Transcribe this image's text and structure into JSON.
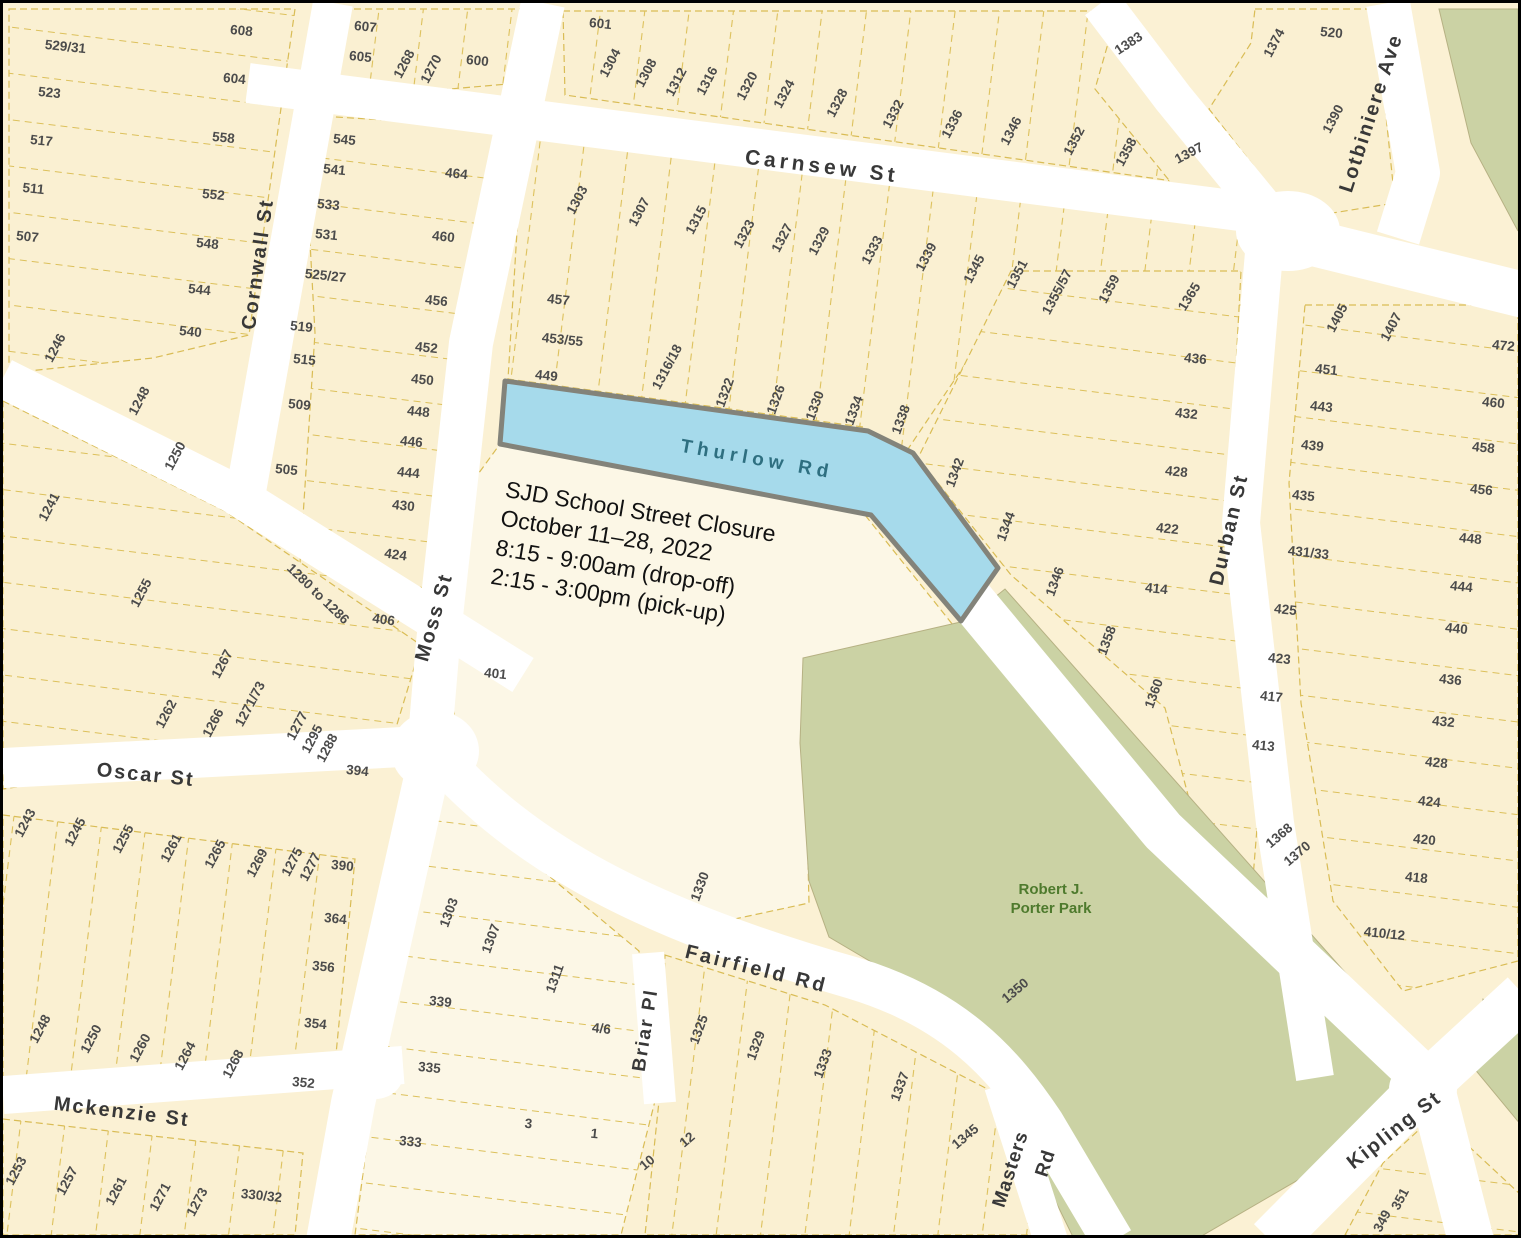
{
  "title": "SJD School Street Closure map",
  "colors": {
    "parcel_fill": "#FAF0D2",
    "parcel_fill_light": "#FCF7E6",
    "parcel_line": "#D9BC55",
    "street_fill": "#FFFFFF",
    "park_fill": "#CBD2A4",
    "closure_fill": "#A6DAEB",
    "closure_border": "#83837A",
    "street_label": "#383838",
    "lot_label": "#4B4B4B",
    "thurlow_label": "#2E6F80",
    "park_label": "#4E7A2D"
  },
  "annotation": {
    "lines": [
      "SJD School Street Closure",
      "October 11–28, 2022",
      "8:15 - 9:00am (drop-off)",
      "2:15 - 3:00pm (pick-up)"
    ]
  },
  "park": {
    "line1": "Robert J.",
    "line2": "Porter Park"
  },
  "street_labels": [
    {
      "text": "Carnsew St",
      "x": 818,
      "y": 170,
      "rot": 7,
      "size": 21,
      "ls": 4
    },
    {
      "text": "Cornwall St",
      "x": 261,
      "y": 262,
      "rot": -82,
      "size": 20,
      "ls": 2
    },
    {
      "text": "Moss St",
      "x": 437,
      "y": 616,
      "rot": -74,
      "size": 20,
      "ls": 2
    },
    {
      "text": "Thurlow Rd",
      "x": 753,
      "y": 462,
      "rot": 10,
      "size": 19,
      "ls": 5,
      "color": "#2E6F80"
    },
    {
      "text": "Oscar St",
      "x": 142,
      "y": 778,
      "rot": 6,
      "size": 20,
      "ls": 2
    },
    {
      "text": "Mckenzie St",
      "x": 118,
      "y": 1115,
      "rot": 7,
      "size": 20,
      "ls": 2
    },
    {
      "text": "Fairfield Rd",
      "x": 752,
      "y": 972,
      "rot": 14,
      "size": 20,
      "ls": 3
    },
    {
      "text": "Briar Pl",
      "x": 648,
      "y": 1028,
      "rot": -81,
      "size": 19,
      "ls": 2
    },
    {
      "text": "Masters",
      "x": 1013,
      "y": 1168,
      "rot": -72,
      "size": 19,
      "ls": 1
    },
    {
      "text": "Rd",
      "x": 1048,
      "y": 1162,
      "rot": -72,
      "size": 19,
      "ls": 1
    },
    {
      "text": "Durban St",
      "x": 1232,
      "y": 528,
      "rot": -77,
      "size": 20,
      "ls": 2
    },
    {
      "text": "Lotbiniere Ave",
      "x": 1374,
      "y": 112,
      "rot": -72,
      "size": 20,
      "ls": 2
    },
    {
      "text": "Kipling St",
      "x": 1395,
      "y": 1132,
      "rot": -38,
      "size": 20,
      "ls": 2
    }
  ],
  "lots": [
    {
      "t": "529/31",
      "x": 62,
      "y": 48,
      "r": 6
    },
    {
      "t": "523",
      "x": 46,
      "y": 94,
      "r": 6
    },
    {
      "t": "517",
      "x": 38,
      "y": 142,
      "r": 6
    },
    {
      "t": "511",
      "x": 30,
      "y": 190,
      "r": 6
    },
    {
      "t": "507",
      "x": 24,
      "y": 238,
      "r": 6
    },
    {
      "t": "608",
      "x": 238,
      "y": 32,
      "r": 6
    },
    {
      "t": "604",
      "x": 231,
      "y": 80,
      "r": 6
    },
    {
      "t": "558",
      "x": 220,
      "y": 139,
      "r": 6
    },
    {
      "t": "552",
      "x": 210,
      "y": 196,
      "r": 6
    },
    {
      "t": "548",
      "x": 204,
      "y": 245,
      "r": 6
    },
    {
      "t": "544",
      "x": 196,
      "y": 291,
      "r": 6
    },
    {
      "t": "540",
      "x": 187,
      "y": 333,
      "r": 6
    },
    {
      "t": "1246",
      "x": 56,
      "y": 347,
      "r": -62
    },
    {
      "t": "1248",
      "x": 140,
      "y": 400,
      "r": -62
    },
    {
      "t": "1250",
      "x": 176,
      "y": 455,
      "r": -62
    },
    {
      "t": "1241",
      "x": 50,
      "y": 506,
      "r": -62
    },
    {
      "t": "1255",
      "x": 142,
      "y": 592,
      "r": -62
    },
    {
      "t": "607",
      "x": 362,
      "y": 28,
      "r": 6
    },
    {
      "t": "605",
      "x": 357,
      "y": 58,
      "r": 6
    },
    {
      "t": "1268",
      "x": 405,
      "y": 63,
      "r": -62
    },
    {
      "t": "1270",
      "x": 432,
      "y": 68,
      "r": -62
    },
    {
      "t": "600",
      "x": 474,
      "y": 62,
      "r": 6
    },
    {
      "t": "545",
      "x": 341,
      "y": 141,
      "r": 6
    },
    {
      "t": "541",
      "x": 331,
      "y": 171,
      "r": 6
    },
    {
      "t": "533",
      "x": 325,
      "y": 206,
      "r": 6
    },
    {
      "t": "531",
      "x": 323,
      "y": 236,
      "r": 6
    },
    {
      "t": "525/27",
      "x": 322,
      "y": 277,
      "r": 6
    },
    {
      "t": "519",
      "x": 298,
      "y": 328,
      "r": 6
    },
    {
      "t": "515",
      "x": 301,
      "y": 361,
      "r": 6
    },
    {
      "t": "509",
      "x": 296,
      "y": 406,
      "r": 6
    },
    {
      "t": "505",
      "x": 283,
      "y": 471,
      "r": 6
    },
    {
      "t": "464",
      "x": 453,
      "y": 175,
      "r": 6
    },
    {
      "t": "460",
      "x": 440,
      "y": 238,
      "r": 6
    },
    {
      "t": "456",
      "x": 433,
      "y": 302,
      "r": 6
    },
    {
      "t": "452",
      "x": 423,
      "y": 349,
      "r": 6
    },
    {
      "t": "450",
      "x": 419,
      "y": 381,
      "r": 6
    },
    {
      "t": "448",
      "x": 415,
      "y": 413,
      "r": 6
    },
    {
      "t": "446",
      "x": 408,
      "y": 443,
      "r": 6
    },
    {
      "t": "444",
      "x": 405,
      "y": 474,
      "r": 6
    },
    {
      "t": "430",
      "x": 400,
      "y": 507,
      "r": 6
    },
    {
      "t": "424",
      "x": 392,
      "y": 556,
      "r": 8
    },
    {
      "t": "406",
      "x": 380,
      "y": 621,
      "r": 8
    },
    {
      "t": "1280 to 1286",
      "x": 312,
      "y": 594,
      "r": 44
    },
    {
      "t": "601",
      "x": 597,
      "y": 25,
      "r": 6
    },
    {
      "t": "1304",
      "x": 611,
      "y": 62,
      "r": -62
    },
    {
      "t": "1308",
      "x": 647,
      "y": 72,
      "r": -62
    },
    {
      "t": "1312",
      "x": 677,
      "y": 81,
      "r": -62
    },
    {
      "t": "1316",
      "x": 708,
      "y": 80,
      "r": -62
    },
    {
      "t": "1320",
      "x": 748,
      "y": 85,
      "r": -62
    },
    {
      "t": "1324",
      "x": 785,
      "y": 93,
      "r": -62
    },
    {
      "t": "1328",
      "x": 838,
      "y": 102,
      "r": -62
    },
    {
      "t": "1332",
      "x": 894,
      "y": 113,
      "r": -62
    },
    {
      "t": "1336",
      "x": 953,
      "y": 123,
      "r": -62
    },
    {
      "t": "1346",
      "x": 1012,
      "y": 130,
      "r": -62
    },
    {
      "t": "1352",
      "x": 1075,
      "y": 140,
      "r": -62
    },
    {
      "t": "1358",
      "x": 1127,
      "y": 151,
      "r": -62
    },
    {
      "t": "1383",
      "x": 1128,
      "y": 44,
      "r": -33
    },
    {
      "t": "1397",
      "x": 1188,
      "y": 154,
      "r": -28
    },
    {
      "t": "1374",
      "x": 1275,
      "y": 42,
      "r": -62
    },
    {
      "t": "520",
      "x": 1328,
      "y": 34,
      "r": 6
    },
    {
      "t": "1390",
      "x": 1334,
      "y": 118,
      "r": -62
    },
    {
      "t": "1303",
      "x": 578,
      "y": 199,
      "r": -62
    },
    {
      "t": "1307",
      "x": 640,
      "y": 211,
      "r": -62
    },
    {
      "t": "1315",
      "x": 697,
      "y": 219,
      "r": -62
    },
    {
      "t": "1323",
      "x": 745,
      "y": 233,
      "r": -62
    },
    {
      "t": "1327",
      "x": 783,
      "y": 237,
      "r": -62
    },
    {
      "t": "1329",
      "x": 820,
      "y": 240,
      "r": -62
    },
    {
      "t": "1333",
      "x": 873,
      "y": 249,
      "r": -62
    },
    {
      "t": "1339",
      "x": 927,
      "y": 256,
      "r": -62
    },
    {
      "t": "1345",
      "x": 975,
      "y": 268,
      "r": -62
    },
    {
      "t": "1351",
      "x": 1018,
      "y": 273,
      "r": -62
    },
    {
      "t": "1355/57",
      "x": 1058,
      "y": 291,
      "r": -62
    },
    {
      "t": "1359",
      "x": 1110,
      "y": 288,
      "r": -62
    },
    {
      "t": "1365",
      "x": 1190,
      "y": 296,
      "r": -58
    },
    {
      "t": "457",
      "x": 555,
      "y": 301,
      "r": 6
    },
    {
      "t": "453/55",
      "x": 559,
      "y": 341,
      "r": 6
    },
    {
      "t": "449",
      "x": 543,
      "y": 377,
      "r": 6
    },
    {
      "t": "1316/18",
      "x": 668,
      "y": 366,
      "r": -62
    },
    {
      "t": "1322",
      "x": 726,
      "y": 391,
      "r": -70
    },
    {
      "t": "1326",
      "x": 777,
      "y": 398,
      "r": -70
    },
    {
      "t": "1330",
      "x": 816,
      "y": 404,
      "r": -70
    },
    {
      "t": "1334",
      "x": 855,
      "y": 409,
      "r": -70
    },
    {
      "t": "1338",
      "x": 902,
      "y": 418,
      "r": -70
    },
    {
      "t": "1342",
      "x": 956,
      "y": 471,
      "r": -70
    },
    {
      "t": "1344",
      "x": 1007,
      "y": 525,
      "r": -70
    },
    {
      "t": "1346",
      "x": 1056,
      "y": 580,
      "r": -70
    },
    {
      "t": "1358",
      "x": 1108,
      "y": 639,
      "r": -70
    },
    {
      "t": "1360",
      "x": 1155,
      "y": 692,
      "r": -70
    },
    {
      "t": "436",
      "x": 1192,
      "y": 360,
      "r": 6
    },
    {
      "t": "432",
      "x": 1183,
      "y": 415,
      "r": 6
    },
    {
      "t": "428",
      "x": 1173,
      "y": 473,
      "r": 6
    },
    {
      "t": "422",
      "x": 1164,
      "y": 530,
      "r": 6
    },
    {
      "t": "414",
      "x": 1153,
      "y": 590,
      "r": 6
    },
    {
      "t": "1405",
      "x": 1338,
      "y": 317,
      "r": -62
    },
    {
      "t": "1407",
      "x": 1392,
      "y": 326,
      "r": -62
    },
    {
      "t": "451",
      "x": 1323,
      "y": 371,
      "r": 6
    },
    {
      "t": "443",
      "x": 1318,
      "y": 408,
      "r": 6
    },
    {
      "t": "439",
      "x": 1309,
      "y": 447,
      "r": 6
    },
    {
      "t": "435",
      "x": 1300,
      "y": 497,
      "r": 6
    },
    {
      "t": "431/33",
      "x": 1305,
      "y": 554,
      "r": 6
    },
    {
      "t": "425",
      "x": 1282,
      "y": 611,
      "r": 6
    },
    {
      "t": "423",
      "x": 1276,
      "y": 660,
      "r": 6
    },
    {
      "t": "417",
      "x": 1268,
      "y": 698,
      "r": 6
    },
    {
      "t": "413",
      "x": 1260,
      "y": 747,
      "r": 6
    },
    {
      "t": "1368",
      "x": 1279,
      "y": 836,
      "r": -40
    },
    {
      "t": "1370",
      "x": 1297,
      "y": 854,
      "r": -40
    },
    {
      "t": "472",
      "x": 1500,
      "y": 347,
      "r": 6
    },
    {
      "t": "460",
      "x": 1490,
      "y": 404,
      "r": 6
    },
    {
      "t": "458",
      "x": 1480,
      "y": 449,
      "r": 6
    },
    {
      "t": "456",
      "x": 1478,
      "y": 491,
      "r": 6
    },
    {
      "t": "448",
      "x": 1467,
      "y": 540,
      "r": 6
    },
    {
      "t": "444",
      "x": 1458,
      "y": 588,
      "r": 6
    },
    {
      "t": "440",
      "x": 1453,
      "y": 630,
      "r": 6
    },
    {
      "t": "436",
      "x": 1447,
      "y": 681,
      "r": 6
    },
    {
      "t": "432",
      "x": 1440,
      "y": 723,
      "r": 6
    },
    {
      "t": "428",
      "x": 1433,
      "y": 764,
      "r": 6
    },
    {
      "t": "424",
      "x": 1426,
      "y": 803,
      "r": 6
    },
    {
      "t": "420",
      "x": 1421,
      "y": 841,
      "r": 6
    },
    {
      "t": "418",
      "x": 1413,
      "y": 879,
      "r": 6
    },
    {
      "t": "410/12",
      "x": 1381,
      "y": 935,
      "r": 6
    },
    {
      "t": "1267",
      "x": 223,
      "y": 663,
      "r": -62
    },
    {
      "t": "1262",
      "x": 167,
      "y": 713,
      "r": -62
    },
    {
      "t": "1266",
      "x": 214,
      "y": 722,
      "r": -62
    },
    {
      "t": "1271/73",
      "x": 251,
      "y": 703,
      "r": -62
    },
    {
      "t": "1277",
      "x": 298,
      "y": 725,
      "r": -62
    },
    {
      "t": "1295",
      "x": 313,
      "y": 738,
      "r": -62
    },
    {
      "t": "1288",
      "x": 328,
      "y": 747,
      "r": -62
    },
    {
      "t": "394",
      "x": 354,
      "y": 772,
      "r": 6
    },
    {
      "t": "401",
      "x": 492,
      "y": 675,
      "r": 6
    },
    {
      "t": "1243",
      "x": 26,
      "y": 822,
      "r": -62
    },
    {
      "t": "1245",
      "x": 76,
      "y": 831,
      "r": -62
    },
    {
      "t": "1255",
      "x": 124,
      "y": 838,
      "r": -62
    },
    {
      "t": "1261",
      "x": 172,
      "y": 847,
      "r": -62
    },
    {
      "t": "1265",
      "x": 216,
      "y": 853,
      "r": -62
    },
    {
      "t": "1269",
      "x": 258,
      "y": 862,
      "r": -62
    },
    {
      "t": "1275",
      "x": 293,
      "y": 861,
      "r": -62
    },
    {
      "t": "1277",
      "x": 311,
      "y": 866,
      "r": -62
    },
    {
      "t": "390",
      "x": 339,
      "y": 867,
      "r": 6
    },
    {
      "t": "364",
      "x": 332,
      "y": 920,
      "r": 6
    },
    {
      "t": "356",
      "x": 320,
      "y": 968,
      "r": 6
    },
    {
      "t": "354",
      "x": 312,
      "y": 1025,
      "r": 6
    },
    {
      "t": "352",
      "x": 300,
      "y": 1084,
      "r": 6
    },
    {
      "t": "1248",
      "x": 41,
      "y": 1028,
      "r": -62
    },
    {
      "t": "1250",
      "x": 92,
      "y": 1038,
      "r": -62
    },
    {
      "t": "1260",
      "x": 141,
      "y": 1047,
      "r": -62
    },
    {
      "t": "1264",
      "x": 186,
      "y": 1055,
      "r": -62
    },
    {
      "t": "1268",
      "x": 234,
      "y": 1063,
      "r": -62
    },
    {
      "t": "1253",
      "x": 17,
      "y": 1170,
      "r": -62
    },
    {
      "t": "1257",
      "x": 68,
      "y": 1180,
      "r": -62
    },
    {
      "t": "1261",
      "x": 117,
      "y": 1190,
      "r": -62
    },
    {
      "t": "1271",
      "x": 161,
      "y": 1196,
      "r": -62
    },
    {
      "t": "1273",
      "x": 198,
      "y": 1201,
      "r": -62
    },
    {
      "t": "330/32",
      "x": 258,
      "y": 1197,
      "r": 6
    },
    {
      "t": "1303",
      "x": 450,
      "y": 911,
      "r": -70
    },
    {
      "t": "1307",
      "x": 492,
      "y": 937,
      "r": -70
    },
    {
      "t": "1311",
      "x": 556,
      "y": 977,
      "r": -70
    },
    {
      "t": "339",
      "x": 437,
      "y": 1003,
      "r": 6
    },
    {
      "t": "335",
      "x": 426,
      "y": 1069,
      "r": 6
    },
    {
      "t": "333",
      "x": 407,
      "y": 1143,
      "r": 6
    },
    {
      "t": "4/6",
      "x": 598,
      "y": 1030,
      "r": 6
    },
    {
      "t": "3",
      "x": 525,
      "y": 1125,
      "r": 6
    },
    {
      "t": "1",
      "x": 591,
      "y": 1135,
      "r": 6
    },
    {
      "t": "1330",
      "x": 701,
      "y": 885,
      "r": -70
    },
    {
      "t": "1325",
      "x": 700,
      "y": 1028,
      "r": -70
    },
    {
      "t": "1329",
      "x": 757,
      "y": 1044,
      "r": -70
    },
    {
      "t": "1333",
      "x": 824,
      "y": 1062,
      "r": -70
    },
    {
      "t": "1337",
      "x": 901,
      "y": 1085,
      "r": -70
    },
    {
      "t": "1345",
      "x": 965,
      "y": 1137,
      "r": -40
    },
    {
      "t": "12",
      "x": 687,
      "y": 1140,
      "r": -40
    },
    {
      "t": "10",
      "x": 647,
      "y": 1163,
      "r": -40
    },
    {
      "t": "1350",
      "x": 1015,
      "y": 991,
      "r": -40
    },
    {
      "t": "351",
      "x": 1401,
      "y": 1198,
      "r": -62
    },
    {
      "t": "349",
      "x": 1383,
      "y": 1220,
      "r": -62
    }
  ]
}
